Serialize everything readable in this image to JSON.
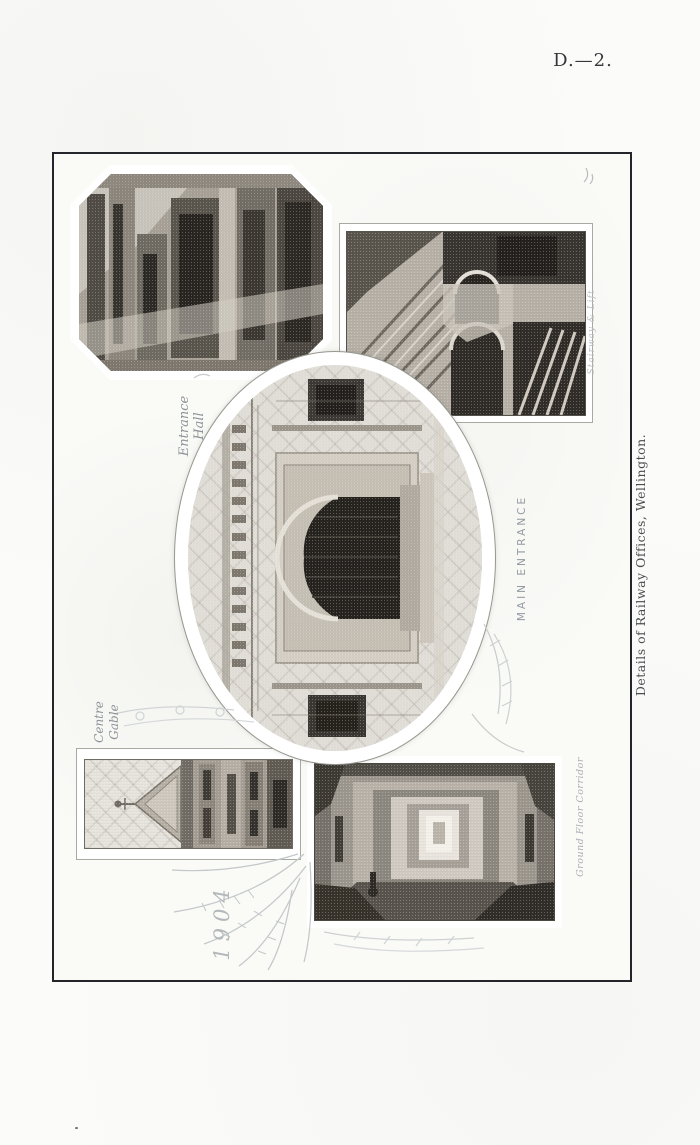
{
  "page": {
    "plate_number": "D.—2.",
    "side_caption": "Details of Railway Offices, Wellington."
  },
  "photos": {
    "entrance_hall": {
      "label_line1": "Entrance",
      "label_line2": "Hall"
    },
    "stairway_lift": {
      "label": "Stairway & Lift"
    },
    "main_entrance": {
      "label": "MAIN ENTRANCE"
    },
    "centre_gable": {
      "label_line1": "Centre",
      "label_line2": "Gable"
    },
    "ground_floor_corridor": {
      "label": "Ground Floor Corridor"
    }
  },
  "annotations": {
    "year": "1904"
  },
  "colors": {
    "paper": "#fbfbf9",
    "frame_ink": "#23252a",
    "caption_ink": "#4a4d50",
    "handwriting_ink": "#8e9399"
  }
}
